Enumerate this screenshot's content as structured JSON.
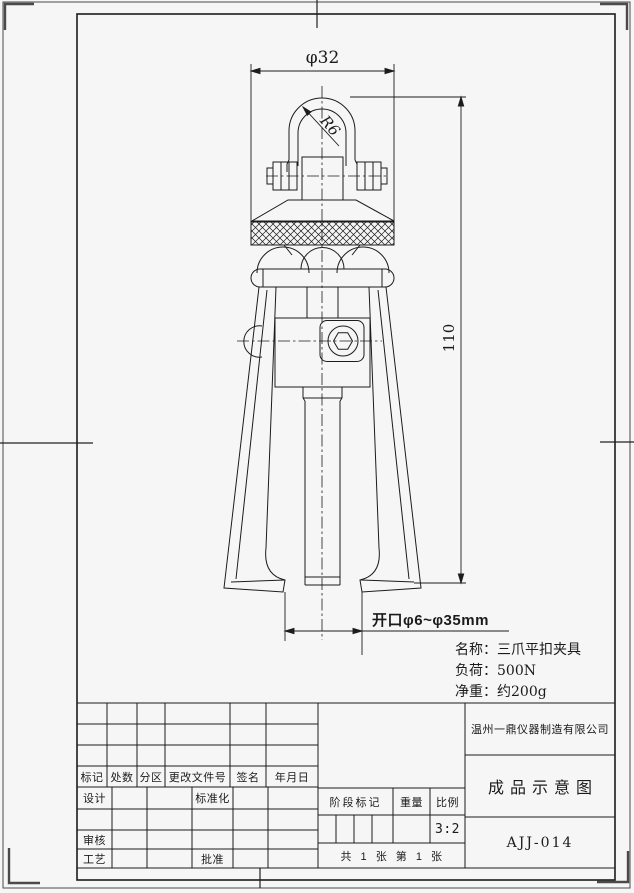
{
  "sheet": {
    "bg_color": "#f6f6f6",
    "line_color": "#1c1c1c"
  },
  "annotations": {
    "top_diameter": "φ32",
    "shackle_radius": "R6",
    "overall_height": "110",
    "opening_range": "开口φ6~φ35mm"
  },
  "notes": {
    "lines": [
      "名称：三爪平扣夹具",
      "负荷：500N",
      "净重：约200g"
    ]
  },
  "title_block": {
    "record_headers": [
      "标记",
      "处数",
      "分区",
      "更改文件号",
      "签名",
      "年月日"
    ],
    "roles": {
      "design": "设计",
      "standardization": "标准化",
      "audit": "审核",
      "process": "工艺",
      "approve": "批准"
    },
    "middle": {
      "stage_mark": "阶段标记",
      "weight": "重量",
      "scale": "比例",
      "scale_value": "3:2",
      "sheet_count": "共 1 张  第 1 张"
    },
    "company": "温州一鼎仪器制造有限公司",
    "drawing_title": "成品示意图",
    "drawing_no": "AJJ-014"
  }
}
